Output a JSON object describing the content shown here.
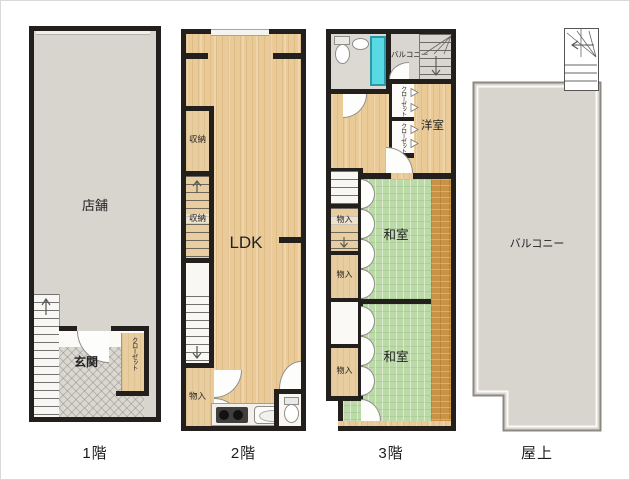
{
  "plan_type": "floorplan",
  "palette": {
    "wall": "#221f1d",
    "shop_floor": "#d8d5ce",
    "wood_floor": "#eacb98",
    "tatami": "#bcdaa8",
    "dark_wood_strip": "#c99346",
    "closet_tan": "#e7cd9f",
    "tile_floor": "#dbd8d1",
    "shower_unit": "#58d9e3"
  },
  "floors": [
    {
      "label": "1階",
      "rooms": {
        "shop": "店舗",
        "entrance": "玄関",
        "closet": "クローゼット"
      }
    },
    {
      "label": "2階",
      "rooms": {
        "ldk": "LDK",
        "storage_upper": "収納",
        "storage_under_stairs": "収納",
        "closet_bottom": "物入"
      }
    },
    {
      "label": "3階",
      "rooms": {
        "balcony": "バルコニー",
        "western_room": "洋室",
        "closet_upper": "クローゼット",
        "closet_lower": "クローゼット",
        "storage_1": "物入",
        "storage_2": "物入",
        "storage_3": "物入",
        "japanese_room_1": "和室",
        "japanese_room_2": "和室"
      }
    },
    {
      "label": "屋上",
      "rooms": {
        "balcony": "バルコニー"
      }
    }
  ]
}
